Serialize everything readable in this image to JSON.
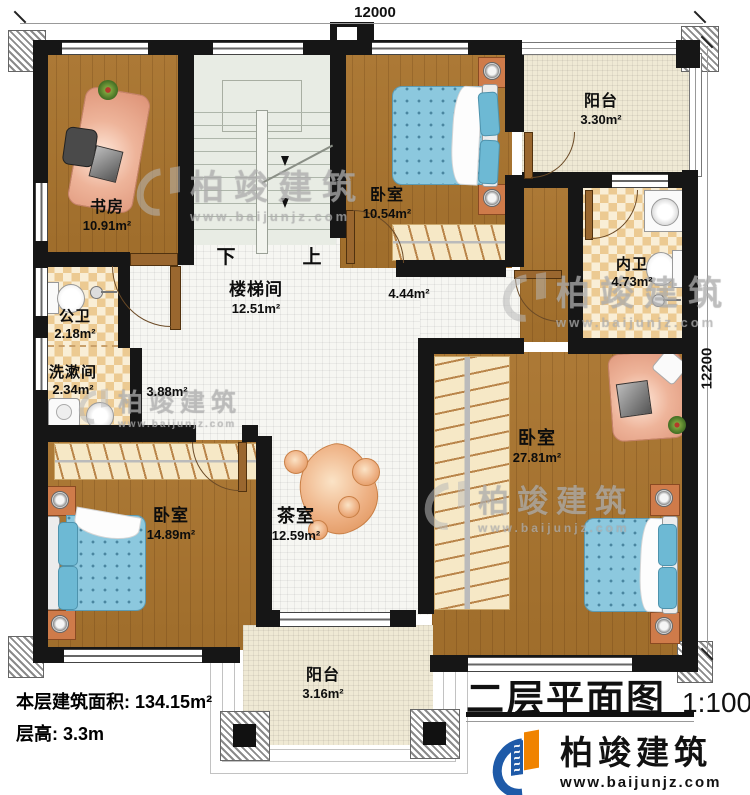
{
  "plan": {
    "title": "二层平面图",
    "scale": "1:100",
    "footer": {
      "area_label": "本层建筑面积:",
      "area_value": "134.15m²",
      "height_label": "层高:",
      "height_value": "3.3m"
    },
    "dimensions": {
      "top": "12000",
      "right": "12200"
    },
    "stairs": {
      "down_label": "下",
      "up_label": "上"
    }
  },
  "rooms": {
    "study": {
      "name": "书房",
      "area": "10.91m²"
    },
    "bedroom_top": {
      "name": "卧室",
      "area": "10.54m²"
    },
    "balcony_top": {
      "name": "阳台",
      "area": "3.30m²"
    },
    "inner_bath": {
      "name": "内卫",
      "area": "4.73m²"
    },
    "stairwell": {
      "name": "楼梯间",
      "area": "12.51m²"
    },
    "public_bath": {
      "name": "公卫",
      "area": "2.18m²"
    },
    "washroom": {
      "name": "洗漱间",
      "area": "2.34m²"
    },
    "hall": {
      "area": "3.88m²"
    },
    "corridor": {
      "area": "4.44m²"
    },
    "bedroom_left": {
      "name": "卧室",
      "area": "14.89m²"
    },
    "tea_room": {
      "name": "茶室",
      "area": "12.59m²"
    },
    "bedroom_master": {
      "name": "卧室",
      "area": "27.81m²"
    },
    "balcony_bottom": {
      "name": "阳台",
      "area": "3.16m²"
    }
  },
  "branding": {
    "watermark_brand": "柏竣建筑",
    "watermark_url": "www.baijunjz.com",
    "logo_brand": "柏竣建筑",
    "logo_url": "www.baijunjz.com"
  },
  "colors": {
    "wall": "#161616",
    "wood_floor": "#a9742e",
    "checker_dark": "#ecca92",
    "checker_light": "#f9eed6",
    "bed_blue": "#8cc8de",
    "logo_blue": "#1e5aa8",
    "logo_orange": "#f08300"
  }
}
